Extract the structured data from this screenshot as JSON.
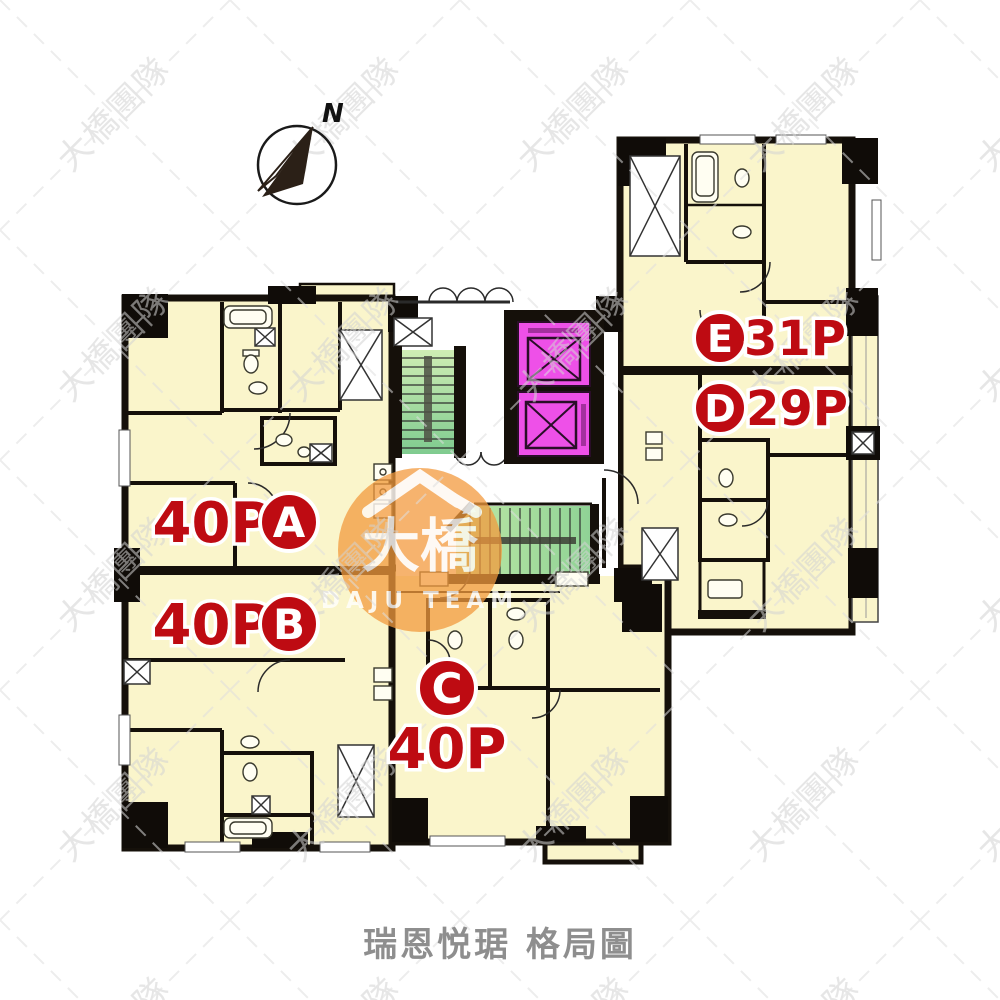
{
  "caption": {
    "text": "瑞恩悦琚 格局圖"
  },
  "compass": {
    "label": "N"
  },
  "watermark": {
    "tile_text": "大橋團隊",
    "logo_text": "大橋",
    "logo_subtext": "DAJU TEAM"
  },
  "units": {
    "A": {
      "name": "A",
      "area": "40P"
    },
    "B": {
      "name": "B",
      "area": "40P"
    },
    "C": {
      "name": "C",
      "area": "40P"
    },
    "D": {
      "name": "D",
      "area": "29P"
    },
    "E": {
      "name": "E",
      "area": "31P"
    }
  },
  "colors": {
    "floor": "#FAF5CB",
    "wall": "#15100A",
    "label_red": "#BE0B12",
    "elevator_magenta": "#EE50E8",
    "stair_green": "#9BD79A",
    "logo_orange": "#F29A3E"
  }
}
